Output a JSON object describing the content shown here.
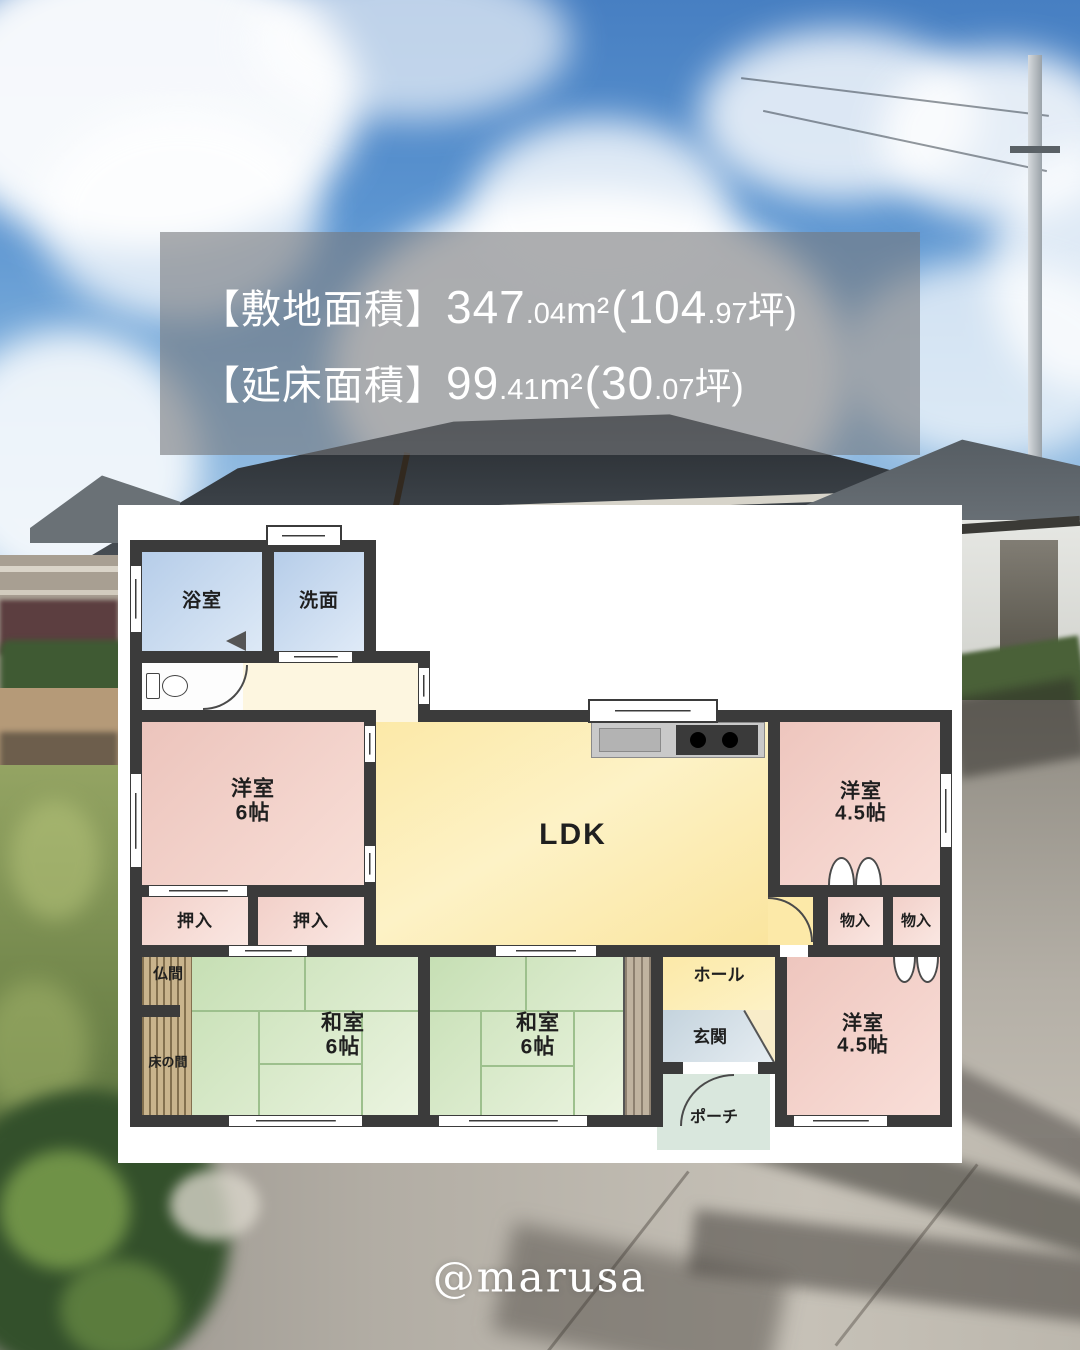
{
  "overlay": {
    "lines": [
      {
        "label": "【敷地面積】",
        "a_int": "347",
        "a_dec": ".04",
        "a_unit": "m²",
        "b_open": "(",
        "b_int": "104",
        "b_dec": ".97",
        "b_close": "坪)"
      },
      {
        "label": "【延床面積】",
        "a_int": "99",
        "a_dec": ".41",
        "a_unit": "m²",
        "b_open": "(",
        "b_int": "30",
        "b_dec": ".07",
        "b_close": "坪)"
      }
    ]
  },
  "floorplan": {
    "labels": {
      "bath": "浴室",
      "wash": "洗面",
      "west": "洋室",
      "west_size6": "6帖",
      "west_size45": "4.5帖",
      "ldk": "LDK",
      "oshiire": "押入",
      "monoire": "物入",
      "butsuma": "仏間",
      "tokonoma": "床の間",
      "washitsu": "和室",
      "washitsu_size": "6帖",
      "hall": "ホール",
      "genkan": "玄関",
      "porch": "ポーチ"
    },
    "colors": {
      "wall": "#3b3b3b",
      "western_room_pink": "#f0cdc6",
      "japanese_room_green": "#cfe4bf",
      "ldk_yellow": "#fbe8a6",
      "water_blue": "#c3d7ee",
      "hallway_cream": "#fdf6e0",
      "entrance_bluegray": "#ccd9e2",
      "porch_green": "#d9e7dd",
      "storage_pink": "#f6dad4",
      "altar_wood": "#c7b28b",
      "engawa_wood": "#bdb09c"
    }
  },
  "watermark": {
    "handle": "@marusa"
  }
}
